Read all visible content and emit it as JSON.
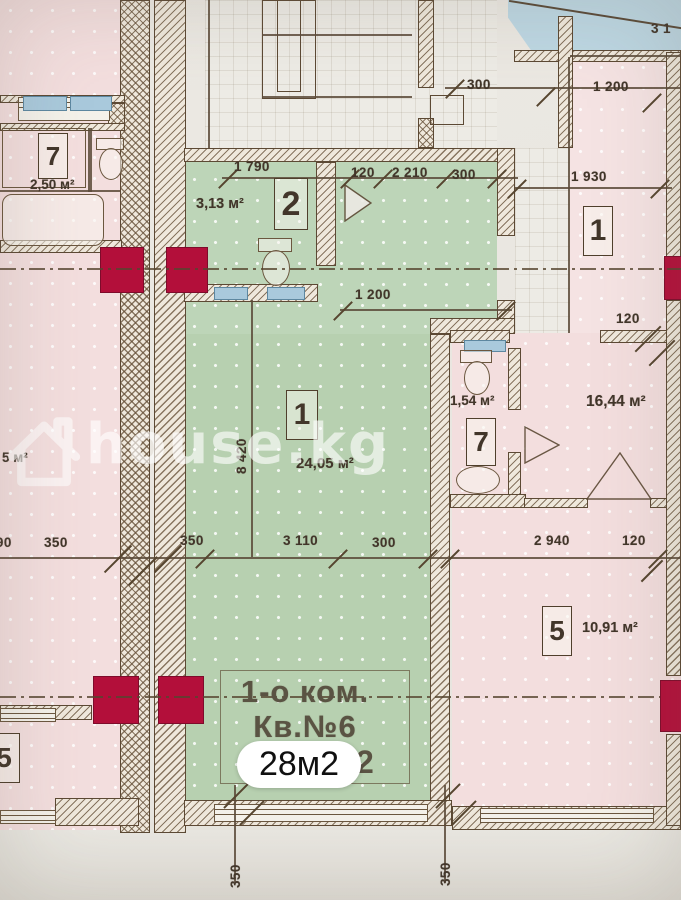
{
  "watermark": {
    "brand": "house.kg"
  },
  "area_badge": {
    "label": "28м2"
  },
  "apartment_label": {
    "line1": "1-о ком.",
    "line2": "Кв.№6",
    "obscured_suffix": "2"
  },
  "rooms": [
    {
      "key": "left-7",
      "number": "7",
      "area": "2,50 м²"
    },
    {
      "key": "left-partial",
      "number": "",
      "area": "5 м²"
    },
    {
      "key": "left-5",
      "number": "5",
      "area": ""
    },
    {
      "key": "green-2",
      "number": "2",
      "area": "3,13 м²"
    },
    {
      "key": "green-1",
      "number": "1",
      "area": "24,05 м²"
    },
    {
      "key": "right-1",
      "number": "1",
      "area": ""
    },
    {
      "key": "right-7",
      "number": "7",
      "area": "1,54 м²"
    },
    {
      "key": "right-16",
      "number": "",
      "area": "16,44 м²"
    },
    {
      "key": "right-5",
      "number": "5",
      "area": "10,91 м²"
    }
  ],
  "dimensions_mm": [
    {
      "text": "1 790",
      "x": 234,
      "y": 159
    },
    {
      "text": "120",
      "x": 351,
      "y": 165
    },
    {
      "text": "2 210",
      "x": 392,
      "y": 165
    },
    {
      "text": "300",
      "x": 452,
      "y": 167
    },
    {
      "text": "1 930",
      "x": 571,
      "y": 169
    },
    {
      "text": "300",
      "x": 467,
      "y": 77
    },
    {
      "text": "1 200",
      "x": 593,
      "y": 79
    },
    {
      "text": "3 1",
      "x": 651,
      "y": 21
    },
    {
      "text": "1 200",
      "x": 355,
      "y": 287
    },
    {
      "text": "120",
      "x": 616,
      "y": 311
    },
    {
      "text": "8 420",
      "x": 234,
      "y": 474,
      "rot": true
    },
    {
      "text": "490",
      "x": -12,
      "y": 535
    },
    {
      "text": "350",
      "x": 44,
      "y": 535
    },
    {
      "text": "350",
      "x": 180,
      "y": 533
    },
    {
      "text": "3 110",
      "x": 283,
      "y": 533
    },
    {
      "text": "300",
      "x": 372,
      "y": 535
    },
    {
      "text": "2 940",
      "x": 534,
      "y": 533
    },
    {
      "text": "120",
      "x": 622,
      "y": 533
    },
    {
      "text": "350",
      "x": 228,
      "y": 888,
      "rot": true
    },
    {
      "text": "350",
      "x": 438,
      "y": 886,
      "rot": true
    }
  ],
  "colors": {
    "highlight_green": "#b7d0b0",
    "bathroom_green": "#bdd5b8",
    "room_pink": "#f3dede",
    "column_red": "#b30f3a",
    "lintel_blue": "#a9c9dc",
    "blueprint_line": "#56452f",
    "paper": "#eae7e1"
  }
}
